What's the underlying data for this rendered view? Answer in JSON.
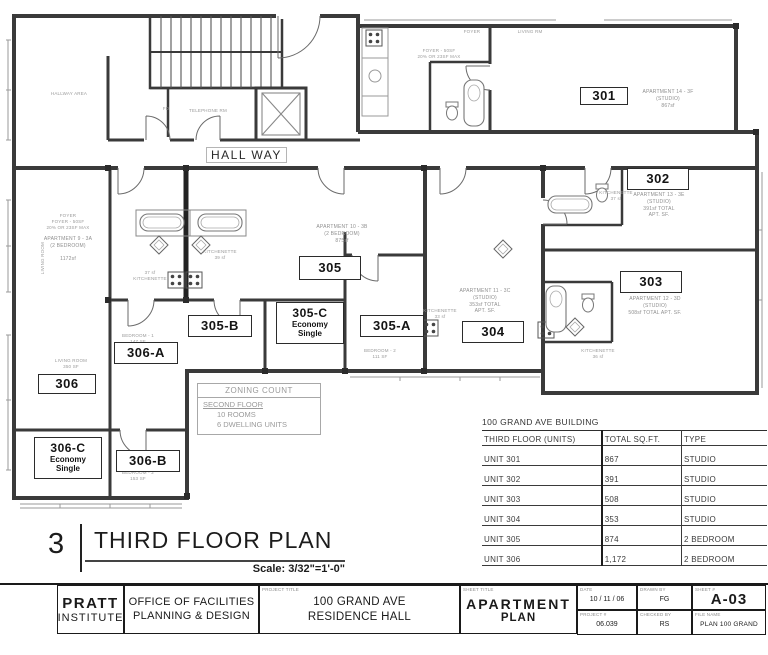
{
  "plan": {
    "hall_way_label": "HALL WAY",
    "small_labels": [
      {
        "lines": [
          "HALLWAY AREA"
        ],
        "x": 38,
        "y": 91,
        "w": 62
      },
      {
        "lines": [
          "TELEPHONE RM"
        ],
        "x": 182,
        "y": 108,
        "w": 52
      },
      {
        "lines": [
          "FD"
        ],
        "x": 160,
        "y": 106,
        "w": 12
      },
      {
        "lines": [
          "FOYER"
        ],
        "x": 452,
        "y": 29,
        "w": 40
      },
      {
        "lines": [
          "LIVING RM"
        ],
        "x": 508,
        "y": 29,
        "w": 44
      },
      {
        "lines": [
          "FOYER - 50SF",
          "20% OR 23SF MAX"
        ],
        "x": 400,
        "y": 48,
        "w": 78
      },
      {
        "lines": [
          "FOYER",
          "FOYER - 50SF",
          "20% OR 23SF MAX"
        ],
        "x": 28,
        "y": 213,
        "w": 80
      },
      {
        "lines": [
          "KITCHENETTE",
          "39 sf"
        ],
        "x": 198,
        "y": 249,
        "w": 44
      },
      {
        "lines": [
          "37 sf",
          "KITCHENETTE"
        ],
        "x": 128,
        "y": 270,
        "w": 44
      },
      {
        "lines": [
          "KITCHENETTE",
          "33 sf"
        ],
        "x": 418,
        "y": 308,
        "w": 44
      },
      {
        "lines": [
          "KITCHENETTE",
          "37 sf"
        ],
        "x": 594,
        "y": 190,
        "w": 44
      },
      {
        "lines": [
          "KITCHENETTE",
          "36 sf"
        ],
        "x": 576,
        "y": 348,
        "w": 44
      },
      {
        "lines": [
          "LIVING ROOM",
          "350 SF"
        ],
        "x": 46,
        "y": 358,
        "w": 50
      },
      {
        "lines": [
          "BEDROOM - 1",
          "131 SF"
        ],
        "x": 212,
        "y": 317,
        "w": 48
      },
      {
        "lines": [
          "BEDROOM - 1",
          "147 SF"
        ],
        "x": 114,
        "y": 333,
        "w": 48
      },
      {
        "lines": [
          "BEDROOM - 2",
          "153 SF"
        ],
        "x": 114,
        "y": 470,
        "w": 48
      },
      {
        "lines": [
          "BEDROOM - 2",
          "111 SF"
        ],
        "x": 356,
        "y": 348,
        "w": 48
      },
      {
        "lines": [
          "LIVING ROOM"
        ],
        "x": 40,
        "y": 242,
        "w": 10,
        "v": true
      }
    ],
    "apartment_notes": [
      {
        "lines": [
          "APARTMENT 14 - 3F",
          "(STUDIO)",
          "867sf"
        ],
        "x": 632,
        "y": 89,
        "w": 72
      },
      {
        "lines": [
          "APARTMENT 13 - 3E",
          "(STUDIO)",
          "391sf TOTAL",
          "APT. SF."
        ],
        "x": 620,
        "y": 192,
        "w": 78
      },
      {
        "lines": [
          "APARTMENT 12 - 3D",
          "(STUDIO)",
          "508sf TOTAL APT. SF."
        ],
        "x": 600,
        "y": 296,
        "w": 110
      },
      {
        "lines": [
          "APARTMENT 11 - 3C",
          "(STUDIO)",
          "353sf TOTAL",
          "APT. SF."
        ],
        "x": 446,
        "y": 288,
        "w": 78
      },
      {
        "lines": [
          "APARTMENT 10 - 3B",
          "(2 BEDROOM)",
          "875sf"
        ],
        "x": 300,
        "y": 224,
        "w": 84
      },
      {
        "lines": [
          "APARTMENT 9 - 3A",
          "(2 BEDROOM)",
          "",
          "1172sf"
        ],
        "x": 28,
        "y": 236,
        "w": 80
      }
    ],
    "room_tags": [
      {
        "label": "301",
        "x": 580,
        "y": 87,
        "w": 48,
        "h": 18
      },
      {
        "label": "302",
        "x": 627,
        "y": 168,
        "w": 62,
        "h": 22
      },
      {
        "label": "303",
        "x": 620,
        "y": 271,
        "w": 62,
        "h": 22
      },
      {
        "label": "304",
        "x": 462,
        "y": 321,
        "w": 62,
        "h": 22
      },
      {
        "label": "305",
        "x": 299,
        "y": 256,
        "w": 62,
        "h": 24
      },
      {
        "label": "305-A",
        "x": 360,
        "y": 315,
        "w": 64,
        "h": 22
      },
      {
        "label": "305-B",
        "x": 188,
        "y": 315,
        "w": 64,
        "h": 22
      },
      {
        "label": "305-C",
        "sub": [
          "Economy",
          "Single"
        ],
        "x": 276,
        "y": 302,
        "w": 68,
        "h": 42
      },
      {
        "label": "306",
        "x": 38,
        "y": 374,
        "w": 58,
        "h": 20
      },
      {
        "label": "306-A",
        "x": 114,
        "y": 342,
        "w": 64,
        "h": 22
      },
      {
        "label": "306-B",
        "x": 116,
        "y": 450,
        "w": 64,
        "h": 22
      },
      {
        "label": "306-C",
        "sub": [
          "Economy",
          "Single"
        ],
        "x": 34,
        "y": 437,
        "w": 68,
        "h": 42
      }
    ]
  },
  "zoning_box": {
    "title": "ZONING COUNT",
    "floor": "SECOND FLOOR",
    "rooms": "10 ROOMS",
    "units": "6 DWELLING UNITS"
  },
  "unit_table": {
    "title": "100 GRAND AVE BUILDING",
    "headers": [
      "THIRD FLOOR (UNITS)",
      "TOTAL SQ.FT.",
      "TYPE"
    ],
    "rows": [
      [
        "UNIT 301",
        "867",
        "STUDIO"
      ],
      [
        "UNIT 302",
        "391",
        "STUDIO"
      ],
      [
        "UNIT 303",
        "508",
        "STUDIO"
      ],
      [
        "UNIT 304",
        "353",
        "STUDIO"
      ],
      [
        "UNIT 305",
        "874",
        "2 BEDROOM"
      ],
      [
        "UNIT 306",
        "1,172",
        "2 BEDROOM"
      ]
    ]
  },
  "drawing_title": {
    "number": "3",
    "title": "THIRD FLOOR PLAN",
    "scale": "Scale: 3/32\"=1'-0\""
  },
  "title_block": {
    "firm_line1": "PRATT",
    "firm_line2": "INSTITUTE",
    "office_line1": "OFFICE OF  FACILITIES",
    "office_line2": "PLANNING & DESIGN",
    "project_title_label": "PROJECT TITLE",
    "project_title_line1": "100 GRAND AVE",
    "project_title_line2": "RESIDENCE HALL",
    "sheet_title_label": "SHEET TITLE",
    "sheet_title_line1": "APARTMENT",
    "sheet_title_line2": "PLAN",
    "date_label": "DATE",
    "date": "10 / 11 / 06",
    "project_no_label": "PROJECT #",
    "project_no": "06.039",
    "drawn_by_label": "DRAWN BY",
    "drawn_by": "FG",
    "checked_by_label": "CHECKED BY",
    "checked_by": "RS",
    "sheet_no_label": "SHEET #",
    "sheet_no": "A-03",
    "file_name_label": "FILE NAME",
    "file_name": "PLAN 100 GRAND"
  }
}
